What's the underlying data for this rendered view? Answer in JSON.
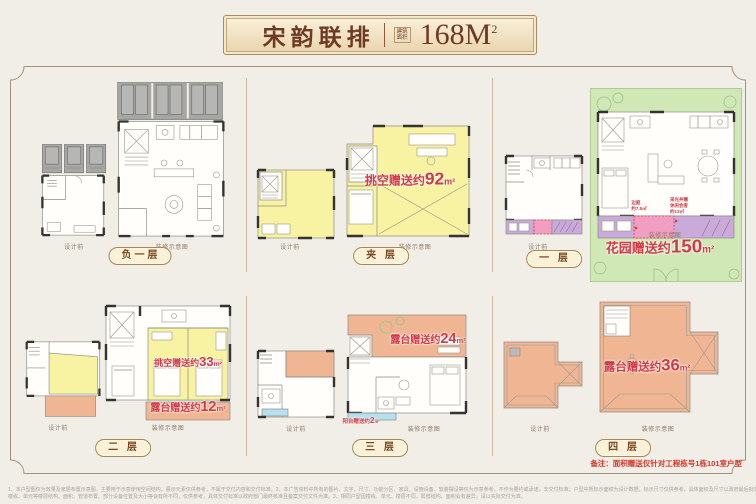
{
  "header": {
    "title": "宋韵联排",
    "area_tag": "建筑面积",
    "area_value": "168M",
    "area_sup": "2"
  },
  "captions": {
    "before": "设计前",
    "after": "装修示意图"
  },
  "floors": {
    "b1": {
      "badge": "负一层"
    },
    "mezz": {
      "badge": "夹 层",
      "note_label": "挑空赠送约",
      "note_value": "92",
      "note_unit": "m²"
    },
    "f1": {
      "badge": "一 层",
      "note_label": "花园赠送约",
      "note_value": "150",
      "note_unit": "m²",
      "side_note_left": "边庭\n约7.5㎡",
      "side_note_right": "采光井赠\n休闲会客\n约13㎡"
    },
    "f2": {
      "badge": "二 层",
      "note_label": "挑空赠送约",
      "note_value": "33",
      "note_unit": "m²",
      "note2_label": "露台赠送约",
      "note2_value": "12",
      "note2_unit": "m²"
    },
    "f3": {
      "badge": "三 层",
      "note_label": "露台赠送约",
      "note_value": "24",
      "note_unit": "m²",
      "note2_label": "阳台赠送约",
      "note2_value": "2",
      "note2_unit": "m²"
    },
    "f4": {
      "badge": "四 层",
      "note_label": "露台赠送约",
      "note_value": "36",
      "note_unit": "m²"
    }
  },
  "footer": {
    "remark": "备注：面积赠送仅针对工程栋号1栋101室户型",
    "disclaimer_1": "1、本户型图仅为效果及家居布置示意图，主要用于示意使用空间结构，展示元素仅供参考，不属于交付内容和交付标准。2、本广告资料中所有的图片、文字、尺寸、功能分区、家具、设施设备、软装摆设等仅为示意参考，不作为要约或承诺，非交付标准；户型中所标示面积为设计数据，标示尺寸仅供参考，具体面积及尺寸以政府最后批准的文件及买卖双方签订的书面合同文件为准。",
    "disclaimer_2": "楼栋、单元等楼层结构、面积、管道布置、部分设备位置及大小等会有所不同，仅供参考，具体交付标准以政府部门最终核准且备案交付文件为准。3、相同户型因楼栋、单元、楼层不同，局部结构、面积会有差异，请以实际交付为准。"
  },
  "colors": {
    "page_bg": "#f1ede7",
    "frame": "#a5927e",
    "banner_text": "#6e3a22",
    "gift_red": "#d13a45",
    "highlight_yellow": "#f7f3a2",
    "garden_green": "#d0e7b6",
    "terrace_salmon": "#f0b694",
    "strip_purple": "#c9aad9",
    "strip_pink": "#f19ec2",
    "strip_blue": "#b5e0ef",
    "badge_gold": "#a8894f"
  }
}
